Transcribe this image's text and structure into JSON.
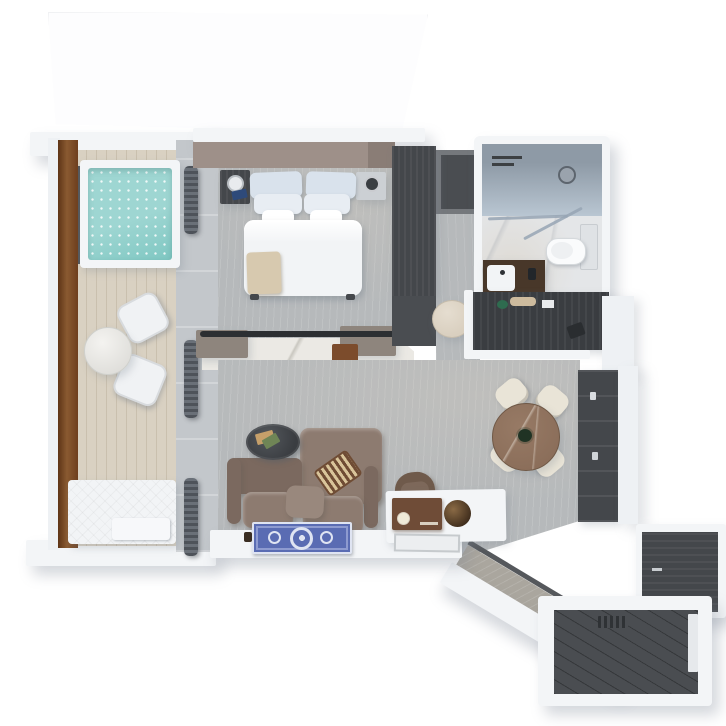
{
  "scene": {
    "type": "3d-floorplan-render",
    "description": "Top-down 3D architectural render of a suite: balcony with plunge pool, bedroom, dressing area, bathroom, living-dining room and entry vestibule",
    "visible_text": "none"
  },
  "palette": {
    "bg": "#ffffff",
    "slab-white": "#f3f5f7",
    "wall-white": "#eef1f4",
    "rail-wood": "#8a5a31",
    "rail-wood-dark": "#6e3f1e",
    "deck-wood": "#d9d1c2",
    "water": "#9ed6d2",
    "water-deep": "#7fc7c2",
    "curtain-wall": "#c3c7cb",
    "curtain-dark": "#4e535a",
    "carpet": "#b6b9bb",
    "headboard": "#9e9089",
    "bed-white": "#f2f4f6",
    "pillow-blue": "#d9e2ec",
    "pillow-pale": "#e8edf3",
    "throw": "#d7c9af",
    "charcoal": "#44474b",
    "charcoal-dark": "#3a3d41",
    "taupe-cab": "#8e857d",
    "marble": "#ebe9e4",
    "marble-vein": "#c9c7c0",
    "tray-wood": "#7c4c2c",
    "sofa": "#8d7b70",
    "sofa-dark": "#7b695f",
    "sofa-light": "#99887d",
    "game-board": "#6f4c34",
    "table-oval": "#3a3d41",
    "book-green": "#6f8556",
    "book-tan": "#c6a06a",
    "rug-blue": "#5a6cb3",
    "rug-light": "#dfe4f2",
    "dining-wood": "#8b6e5a",
    "chair-cream": "#e9e4d7",
    "radio-brown": "#6f4c37",
    "bath-floor": "#e4e6e8",
    "shower-wall": "#8e9aa6",
    "shower-glass": "#b9c6d2",
    "vanity-brown": "#483729",
    "pouf": "#d9cfbf",
    "entry-floor": "#4a4d51",
    "corridor-gray": "#aaa69e"
  },
  "rooms": [
    {
      "name": "balcony",
      "objects": [
        "plunge-pool",
        "wood-railing",
        "deck",
        "outdoor-dining-table",
        "outdoor-chair",
        "outdoor-chair",
        "sun-lounger",
        "curtain-wall"
      ]
    },
    {
      "name": "bedroom",
      "objects": [
        "headboard-wall",
        "king-bed",
        "pillows",
        "throw-blanket",
        "nightstand-left",
        "table-lamp",
        "nightstand-right",
        "marble-console",
        "tv-rail",
        "wood-tray"
      ]
    },
    {
      "name": "dressing-area",
      "objects": [
        "wardrobe",
        "shelf-unit",
        "vanity-pouf"
      ]
    },
    {
      "name": "bathroom",
      "objects": [
        "shower",
        "shower-fixtures",
        "glass-partition",
        "toilet",
        "towel-ledge",
        "vanity-cabinet",
        "sink"
      ]
    },
    {
      "name": "living-room",
      "objects": [
        "sofa",
        "chaise",
        "backgammon-board",
        "coffee-table",
        "books",
        "armchair",
        "marble-media-console",
        "vintage-radio",
        "decor-bowl",
        "picture-frame",
        "ornate-rug",
        "writing-desk",
        "desk-stool",
        "decor-hourglass",
        "decor-hourglass"
      ]
    },
    {
      "name": "dining-area",
      "objects": [
        "round-marble-table",
        "centerpiece-plant",
        "dining-chair",
        "dining-chair",
        "dining-chair",
        "dining-chair",
        "wall-cabinetry"
      ]
    },
    {
      "name": "entry",
      "objects": [
        "diagonal-corridor",
        "corridor-wall",
        "entry-closet",
        "dark-wood-floor",
        "floor-vent",
        "entry-door"
      ]
    }
  ]
}
